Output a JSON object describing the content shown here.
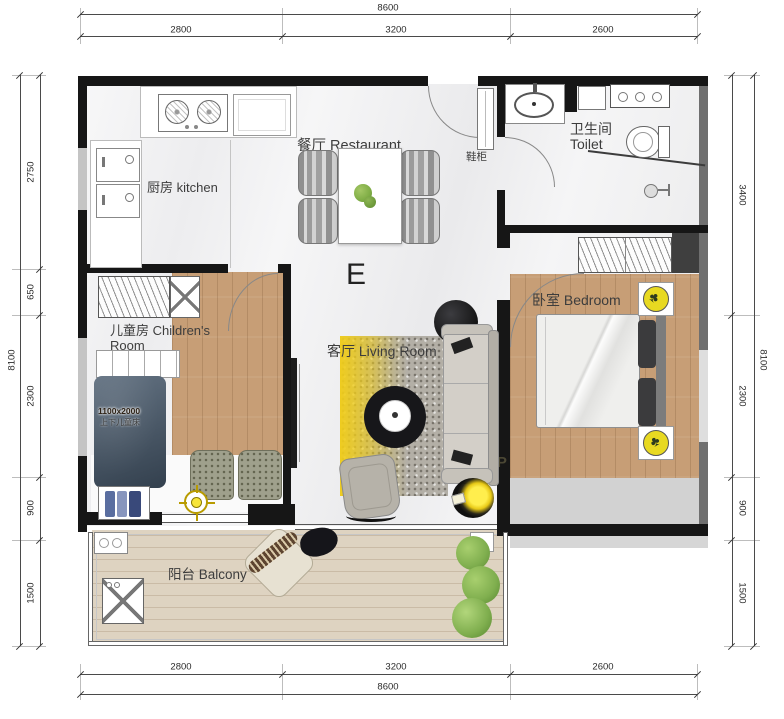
{
  "plan_type_label": "E",
  "rooms": {
    "kitchen": {
      "label": "厨房 kitchen"
    },
    "dining": {
      "label": "餐厅 Restaurant"
    },
    "toilet": {
      "label_zh": "卫生间",
      "label_en": "Toilet"
    },
    "entry": {
      "shoe_cabinet": "鞋柜"
    },
    "children": {
      "label_line1": "儿童房 Children's",
      "label_line2": "Room",
      "bed_size": "1100x2000",
      "bed_note": "上下儿童床"
    },
    "living": {
      "label": "客厅 Living Room"
    },
    "bedroom": {
      "label": "卧室 Bedroom"
    },
    "balcony": {
      "label": "阳台 Balcony"
    }
  },
  "watermark": {
    "line1": "家",
    "line2": "UP"
  },
  "dimensions": {
    "top": {
      "total": "8600",
      "segments": [
        "2800",
        "3200",
        "2600"
      ]
    },
    "bottom": {
      "total": "8600",
      "segments": [
        "2800",
        "3200",
        "2600"
      ]
    },
    "left": {
      "total": "8100",
      "segments": [
        "2750",
        "650",
        "2300",
        "900",
        "1500"
      ]
    },
    "right": {
      "total": "8100",
      "segments": [
        "3400",
        "2300",
        "900",
        "1500"
      ]
    }
  },
  "colors": {
    "wall": "#161616",
    "wall_grey": "#6f6f6f",
    "wood_floor": "#c79e76",
    "balcony_floor": "#ded3c1",
    "accent_yellow": "#efd822",
    "children_bed": "#46586b",
    "plant_green": "#7fae4e"
  }
}
